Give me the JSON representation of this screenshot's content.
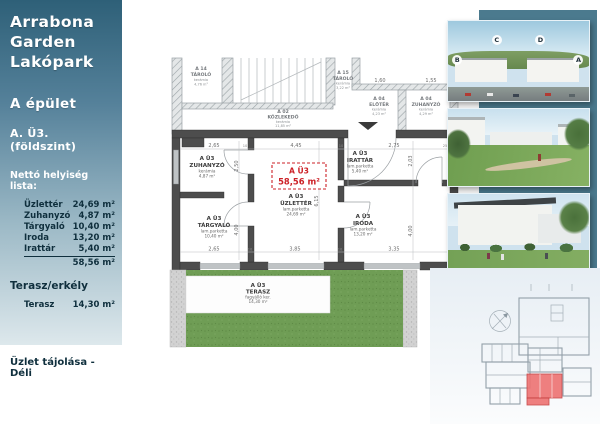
{
  "sidebar": {
    "title_lines": [
      "Arrabona",
      "Garden",
      "Lakópark"
    ],
    "building": "A épület",
    "unit": "A. Ü3. (földszint)",
    "list_heading": "Nettó helyiség lista:",
    "rooms": [
      {
        "name": "Üzlettér",
        "area": "24,69 m²"
      },
      {
        "name": "Zuhanyzó",
        "area": "4,87 m²"
      },
      {
        "name": "Tárgyaló",
        "area": "10,40 m²"
      },
      {
        "name": "Iroda",
        "area": "13,20 m²"
      },
      {
        "name": "Irattár",
        "area": "5,40 m²"
      }
    ],
    "total_area": "58,56 m²",
    "terrace_heading": "Terasz/erkély",
    "terrace_room": {
      "name": "Terasz",
      "area": "14,30 m²"
    },
    "orientation": "Üzlet tájolása - Déli"
  },
  "floor_plan": {
    "unit_label": {
      "id": "A Ü3",
      "area": "58,56 m²"
    },
    "rooms": {
      "zuhanyzo": {
        "id": "A Ü3",
        "name": "ZUHANYZÓ",
        "material": "kerámia",
        "area": "4,87 m²"
      },
      "targyalo": {
        "id": "A Ü3",
        "name": "TÁRGYALÓ",
        "material": "lam.parketta",
        "area": "10,40 m²"
      },
      "uzletter": {
        "id": "A Ü3",
        "name": "ÜZLETTÉR",
        "material": "lam.parketta",
        "area": "24,69 m²"
      },
      "irattar": {
        "id": "A Ü3",
        "name": "IRATTÁR",
        "material": "lam.parketta",
        "area": "5,40 m²"
      },
      "iroda": {
        "id": "A Ü3",
        "name": "IRODA",
        "material": "lam.parketta",
        "area": "13,20 m²"
      },
      "terasz": {
        "id": "A Ü3",
        "name": "TERASZ",
        "material": "fagyálló ker.",
        "area": "14,30 m²"
      }
    },
    "neighbor_rooms": {
      "tarolo_a14": {
        "id": "A 14",
        "name": "TÁROLÓ",
        "material": "kerámia",
        "area": "4,76 m²"
      },
      "kozlekedo": {
        "id": "A 02",
        "name": "KÖZLEKEDŐ",
        "material": "kerámia",
        "area": "11,85 m²"
      },
      "tarolo_a15": {
        "id": "A 15",
        "name": "TÁROLÓ",
        "material": "kerámia",
        "area": "3,22 m²"
      },
      "eloter": {
        "id": "A 04",
        "name": "ELŐTÉR",
        "material": "kerámia",
        "area": "4,23 m²"
      },
      "zuhany_a04": {
        "id": "A 04",
        "name": "ZUHANYZÓ",
        "material": "kerámia",
        "area": "4,29 m²"
      }
    },
    "dims": {
      "top": [
        "2,65",
        "4,45",
        "2,75"
      ],
      "top_small": [
        "10",
        "10",
        "25"
      ],
      "bottom": [
        "2,65",
        "3,85",
        "3,35"
      ],
      "bottom_small": [
        "10",
        "10"
      ],
      "left_v": [
        "2,50",
        "4,00"
      ],
      "mid_v": "6,15",
      "right_v": [
        "2,03",
        "4,00"
      ],
      "upper": [
        "1,60",
        "1,55"
      ]
    }
  },
  "photos": {
    "aerial_labels": [
      "B",
      "C",
      "D",
      "A"
    ]
  },
  "colors": {
    "accent-red": "#cc2127",
    "teal-strip": "#4b7a8e",
    "grass-green": "#6f9d55",
    "sidebar-top": "#2e6078",
    "sidebar-bottom": "#dde8ec",
    "wall-dark": "#4d4d4d"
  }
}
